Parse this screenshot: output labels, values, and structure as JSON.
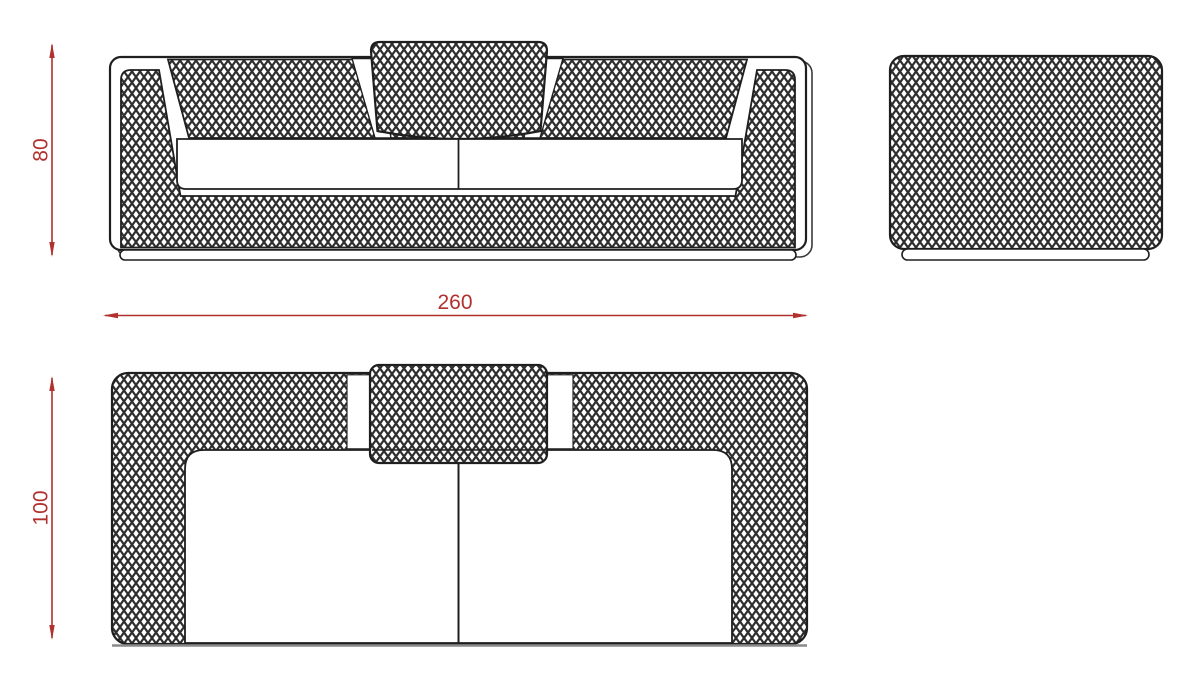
{
  "drawing": {
    "dimensions": {
      "height_label": "80",
      "width_label": "260",
      "depth_label": "100"
    },
    "colors": {
      "dimension_red": "#b0312d",
      "outline_black": "#1f1f1f",
      "baseline_gray": "#8a8a8a",
      "background": "#ffffff"
    },
    "texture": "diamond-mesh-crosshatch"
  }
}
